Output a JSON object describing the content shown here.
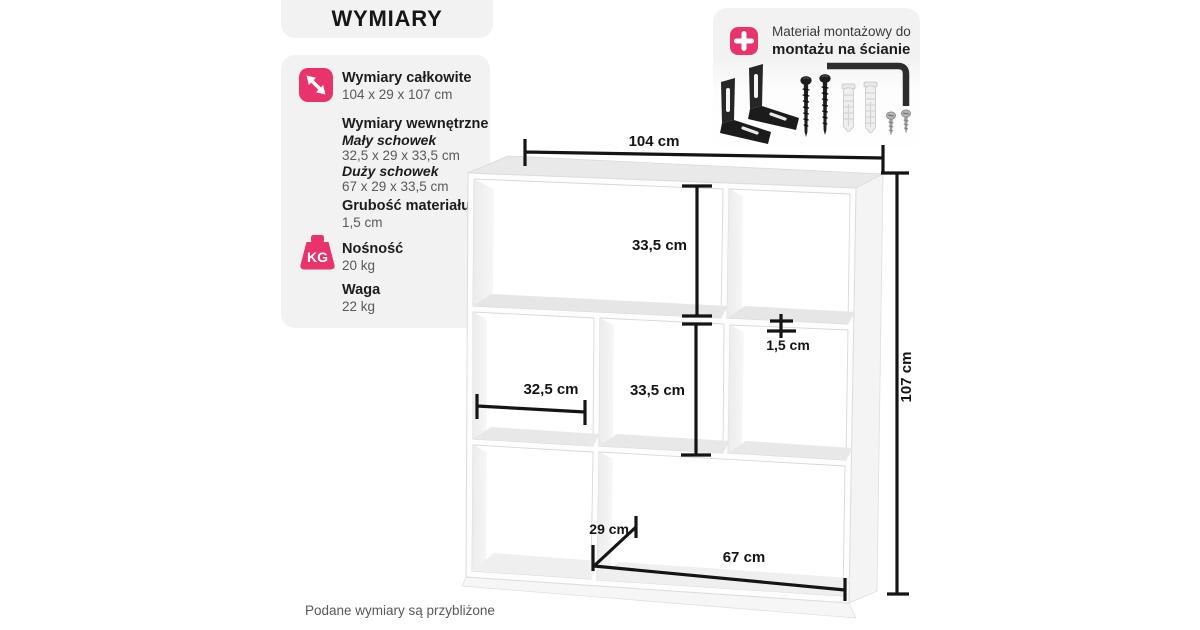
{
  "header": {
    "title": "WYMIARY"
  },
  "specs": {
    "overall_label": "Wymiary całkowite",
    "overall_value": "104 x 29 x 107 cm",
    "internal_label": "Wymiary wewnętrzne",
    "small_label": "Mały schowek",
    "small_value": "32,5 x 29 x 33,5 cm",
    "large_label": "Duży schowek",
    "large_value": "67 x 29 x 33,5 cm",
    "thickness_label": "Grubość materiału",
    "thickness_value": "1,5 cm",
    "capacity_label": "Nośność",
    "capacity_value": "20 kg",
    "weight_label": "Waga",
    "weight_value": "22 kg",
    "kg_icon_text": "KG"
  },
  "mounting": {
    "line1": "Materiał montażowy do",
    "line2": "montażu na ścianie"
  },
  "diagram": {
    "width": "104 cm",
    "height": "107 cm",
    "top_inner_height": "33,5 cm",
    "middle_inner_height": "33,5 cm",
    "thickness": "1,5 cm",
    "inner_width_small": "32,5 cm",
    "depth": "29 cm",
    "inner_width_large": "67 cm"
  },
  "footer": {
    "note": "Podane wymiary są przybliżone"
  },
  "colors": {
    "accent_pink": "#e8336b",
    "panel_gray": "#f2f2f2",
    "line_black": "#141414"
  }
}
